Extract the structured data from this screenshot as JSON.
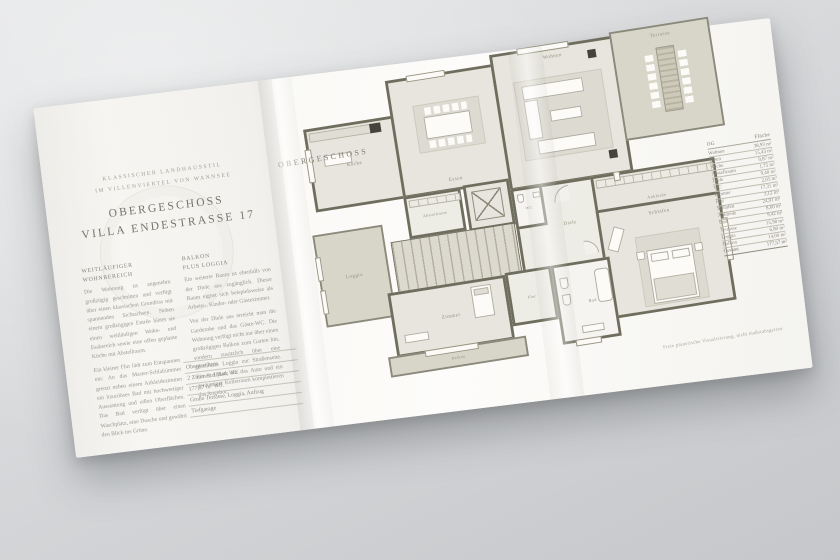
{
  "brochure": {
    "left_panel": {
      "eyebrow_line1": "KLASSISCHER LANDHAUSSTIL",
      "eyebrow_line2": "IM VILLENVIERTEL VON WANNSEE",
      "title_line1": "OBERGESCHOSS",
      "title_line2": "VILLA ENDESTRASSE 17",
      "col1": {
        "heading_line1": "WEITLÄUFIGER",
        "heading_line2": "WOHNBEREICH",
        "para1": "Die Wohnung ist angenehm großzügig geschnitten und verfügt über einen klassischen Grundriss mit spannenden Sichtachsen. Neben einem großzügigen Entrée bietet sie einen weitläufigen Wohn- und Essbereich sowie eine offen geplante Küche mit Abstellraum.",
        "para2": "Ein kleiner Flur lädt zum Entspannen ein: An das Master-Schlafzimmer grenzt neben einem Ankleidezimmer ein luxuriöses Bad mit hochwertiger Ausstattung und edlen Oberflächen. Das Bad verfügt über einen Waschplatz, eine Dusche und gewährt den Blick ins Grüne."
      },
      "col2": {
        "heading_line1": "BALKON",
        "heading_line2": "PLUS LOGGIA",
        "para1": "Ein weiterer Raum ist ebenfalls von der Diele aus zugänglich. Dieser Raum eignet sich beispielsweise als Arbeits-, Kinder- oder Gästezimmer.",
        "para2": "Von der Diele aus erreicht man die Garderobe und das Gäste-WC. Die Wohnung verfügt nicht nur über einen großzügigen Balkon zum Garten hin, sondern zusätzlich über eine geschützte Loggia zur Straßenseite. Ein Stellplatz für das Auto und ein geräumiger Kellerraum komplettieren das Angebot."
      },
      "facts": [
        "Obergeschoss",
        "2 Zimmer, 1 Bad, WC",
        "177,57 m² Wfl.",
        "Große Terrasse, Loggia, Aufzug",
        "Tiefgarage"
      ]
    },
    "plan": {
      "page_label": "OBERGESCHOSS",
      "rooms": {
        "kueche": "Küche",
        "essen": "Essen",
        "wohnen": "Wohnen",
        "terrasse": "Terrasse",
        "loggia": "Loggia",
        "abstellraum": "Abstellraum",
        "aufzug": "Aufzug",
        "wc": "WC",
        "diele": "Diele",
        "ankleide": "Ankleide",
        "schlafen": "Schlafen",
        "zimmer": "Zimmer",
        "flur": "Flur",
        "bad": "Bad",
        "balkon": "Balkon"
      },
      "area_table": {
        "header_left": "OG",
        "header_right": "Fläche",
        "rows": [
          {
            "label": "Wohnen",
            "value": "38,93 m²"
          },
          {
            "label": "Essen",
            "value": "15,43 m²"
          },
          {
            "label": "Küche",
            "value": "9,87 m²"
          },
          {
            "label": "Abstellraum",
            "value": "1,75 m²"
          },
          {
            "label": "Diele",
            "value": "9,40 m²"
          },
          {
            "label": "WC",
            "value": "2,05 m²"
          },
          {
            "label": "Zimmer",
            "value": "17,31 m²"
          },
          {
            "label": "Flur",
            "value": "3,12 m²"
          },
          {
            "label": "Schlafen",
            "value": "24,91 m²"
          },
          {
            "label": "Ankleide",
            "value": "8,60 m²"
          },
          {
            "label": "Bad",
            "value": "9,42 m²"
          },
          {
            "label": "Terrasse",
            "value": "15,98 m²"
          },
          {
            "label": "Loggia",
            "value": "6,80 m²"
          },
          {
            "label": "Balkon",
            "value": "14,00 m²"
          }
        ],
        "total": {
          "label": "Gesamt",
          "value": "177,57 m²"
        }
      },
      "caption": "Freie planerische Visualisierung, nicht maßstabsgetreu"
    },
    "colors": {
      "backdrop": "#d3d5d8",
      "paper": "#fbfaf7",
      "wall": "#6f6e5e",
      "floor": "#e7e5dd",
      "outdoor": "#d8d6c9",
      "accent_dark": "#45443c",
      "ink_title": "#76756c",
      "ink_body": "#9b988f"
    }
  }
}
